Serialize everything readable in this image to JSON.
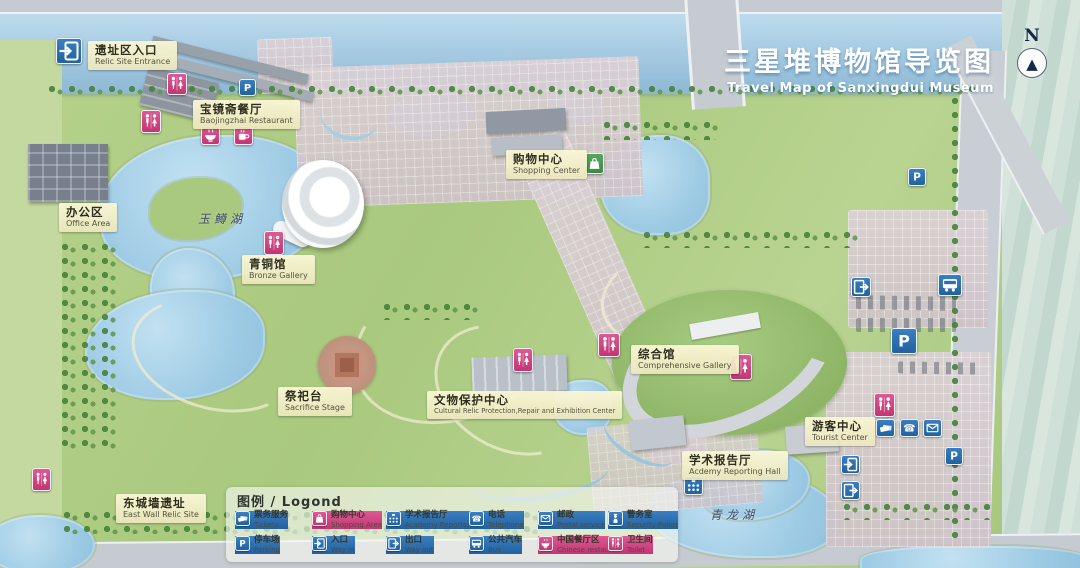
{
  "title": {
    "zh": "三星堆博物馆导览图",
    "en": "Travel Map of Sanxingdui Museum"
  },
  "compass": {
    "label": "N"
  },
  "colors": {
    "icon_blue": "#2a6db5",
    "icon_pink": "#d0437f",
    "icon_green": "#4d9e57",
    "label_bg": "#f4efc9",
    "water": "#a5cce5",
    "title_text": "#ffffff"
  },
  "places": [
    {
      "zh": "遗址区入口",
      "en": "Relic Site Entrance",
      "x": 88,
      "y": 41
    },
    {
      "zh": "宝镜斋餐厅",
      "en": "Baojingzhai Restaurant",
      "x": 193,
      "y": 100
    },
    {
      "zh": "办公区",
      "en": "Office Area",
      "x": 59,
      "y": 203
    },
    {
      "zh": "青铜馆",
      "en": "Bronze Gallery",
      "x": 242,
      "y": 255
    },
    {
      "zh": "购物中心",
      "en": "Shopping Center",
      "x": 506,
      "y": 150
    },
    {
      "zh": "综合馆",
      "en": "Comprehensive Gallery",
      "x": 631,
      "y": 345
    },
    {
      "zh": "祭祀台",
      "en": "Sacrifice Stage",
      "x": 278,
      "y": 387
    },
    {
      "zh": "文物保护中心",
      "en": "Cultural Relic Protection,Repair and Exhibition Center",
      "x": 427,
      "y": 391,
      "cls": "small-en"
    },
    {
      "zh": "学术报告厅",
      "en": "Acdemy Reporting Hall",
      "x": 682,
      "y": 451
    },
    {
      "zh": "游客中心",
      "en": "Tourist Center",
      "x": 805,
      "y": 417
    },
    {
      "zh": "东城墙遗址",
      "en": "East Wall Relic Site",
      "x": 116,
      "y": 494
    }
  ],
  "lakes": [
    {
      "name": "玉鳟湖",
      "x": 198,
      "y": 210
    },
    {
      "name": "青龙湖",
      "x": 710,
      "y": 506
    }
  ],
  "legend": {
    "header": "图例 / Logond",
    "items": [
      {
        "zh": "票务服务",
        "en": "Tickets",
        "icon": "tickets",
        "color": "blue",
        "x": 9,
        "y": 24
      },
      {
        "zh": "购物中心",
        "en": "Shopping Area",
        "icon": "bag",
        "color": "pink",
        "x": 86,
        "y": 24
      },
      {
        "zh": "学术报告厅",
        "en": "Academy Reporting Hall",
        "icon": "academy",
        "color": "blue",
        "x": 160,
        "y": 24
      },
      {
        "zh": "电话",
        "en": "Telephone",
        "icon": "phone",
        "color": "blue",
        "x": 243,
        "y": 24
      },
      {
        "zh": "邮政",
        "en": "Postal service",
        "icon": "mail",
        "color": "blue",
        "x": 312,
        "y": 24
      },
      {
        "zh": "警务室",
        "en": "Security Police",
        "icon": "police",
        "color": "blue",
        "x": 382,
        "y": 24
      },
      {
        "zh": "停车场",
        "en": "Parking",
        "icon": "parking",
        "color": "blue",
        "x": 9,
        "y": 49
      },
      {
        "zh": "入口",
        "en": "Way in",
        "icon": "door-in",
        "color": "blue",
        "x": 86,
        "y": 49
      },
      {
        "zh": "出口",
        "en": "Way out",
        "icon": "door-out",
        "color": "blue",
        "x": 160,
        "y": 49
      },
      {
        "zh": "公共汽车",
        "en": "Bus",
        "icon": "bus",
        "color": "blue",
        "x": 243,
        "y": 49
      },
      {
        "zh": "中国餐厅区",
        "en": "Chinese restaurant",
        "icon": "bowl",
        "color": "pink",
        "x": 312,
        "y": 49
      },
      {
        "zh": "卫生间",
        "en": "Toilet",
        "icon": "toilet",
        "color": "pink",
        "x": 382,
        "y": 49
      }
    ]
  },
  "map_icons": [
    {
      "icon": "door-in",
      "color": "blue",
      "x": 56,
      "y": 38,
      "w": 26,
      "h": 26
    },
    {
      "icon": "toilet",
      "color": "pink",
      "x": 167,
      "y": 73,
      "w": 20,
      "h": 22
    },
    {
      "icon": "toilet",
      "color": "pink",
      "x": 141,
      "y": 110,
      "w": 20,
      "h": 23
    },
    {
      "icon": "parking",
      "color": "blue",
      "x": 239,
      "y": 79,
      "w": 17,
      "h": 17
    },
    {
      "icon": "bowl",
      "color": "pink",
      "x": 201,
      "y": 126,
      "w": 19,
      "h": 19
    },
    {
      "icon": "cup",
      "color": "pink",
      "x": 234,
      "y": 126,
      "w": 19,
      "h": 19
    },
    {
      "icon": "toilet",
      "color": "pink",
      "x": 264,
      "y": 231,
      "w": 20,
      "h": 24
    },
    {
      "icon": "bag",
      "color": "green",
      "x": 585,
      "y": 153,
      "w": 19,
      "h": 21
    },
    {
      "icon": "toilet",
      "color": "pink",
      "x": 513,
      "y": 348,
      "w": 20,
      "h": 24
    },
    {
      "icon": "toilet",
      "color": "pink",
      "x": 598,
      "y": 333,
      "w": 22,
      "h": 24
    },
    {
      "icon": "toilet",
      "color": "pink",
      "x": 730,
      "y": 354,
      "w": 22,
      "h": 26
    },
    {
      "icon": "parking",
      "color": "blue",
      "x": 908,
      "y": 168,
      "w": 18,
      "h": 18
    },
    {
      "icon": "door-out",
      "color": "blue",
      "x": 851,
      "y": 277,
      "w": 20,
      "h": 20
    },
    {
      "icon": "bus",
      "color": "blue",
      "x": 938,
      "y": 274,
      "w": 24,
      "h": 22
    },
    {
      "icon": "parking",
      "color": "blue",
      "x": 891,
      "y": 328,
      "w": 26,
      "h": 26
    },
    {
      "icon": "toilet",
      "color": "pink",
      "x": 874,
      "y": 393,
      "w": 21,
      "h": 24
    },
    {
      "icon": "tickets",
      "color": "blue",
      "x": 876,
      "y": 419,
      "w": 19,
      "h": 18
    },
    {
      "icon": "phone",
      "color": "blue",
      "x": 900,
      "y": 419,
      "w": 19,
      "h": 18
    },
    {
      "icon": "mail",
      "color": "blue",
      "x": 923,
      "y": 419,
      "w": 19,
      "h": 18
    },
    {
      "icon": "door-in",
      "color": "blue",
      "x": 841,
      "y": 455,
      "w": 19,
      "h": 19
    },
    {
      "icon": "door-out",
      "color": "blue",
      "x": 841,
      "y": 481,
      "w": 19,
      "h": 19
    },
    {
      "icon": "academy",
      "color": "blue",
      "x": 684,
      "y": 476,
      "w": 19,
      "h": 19
    },
    {
      "icon": "parking",
      "color": "blue",
      "x": 945,
      "y": 447,
      "w": 18,
      "h": 18
    },
    {
      "icon": "toilet",
      "color": "pink",
      "x": 32,
      "y": 468,
      "w": 19,
      "h": 23
    }
  ]
}
